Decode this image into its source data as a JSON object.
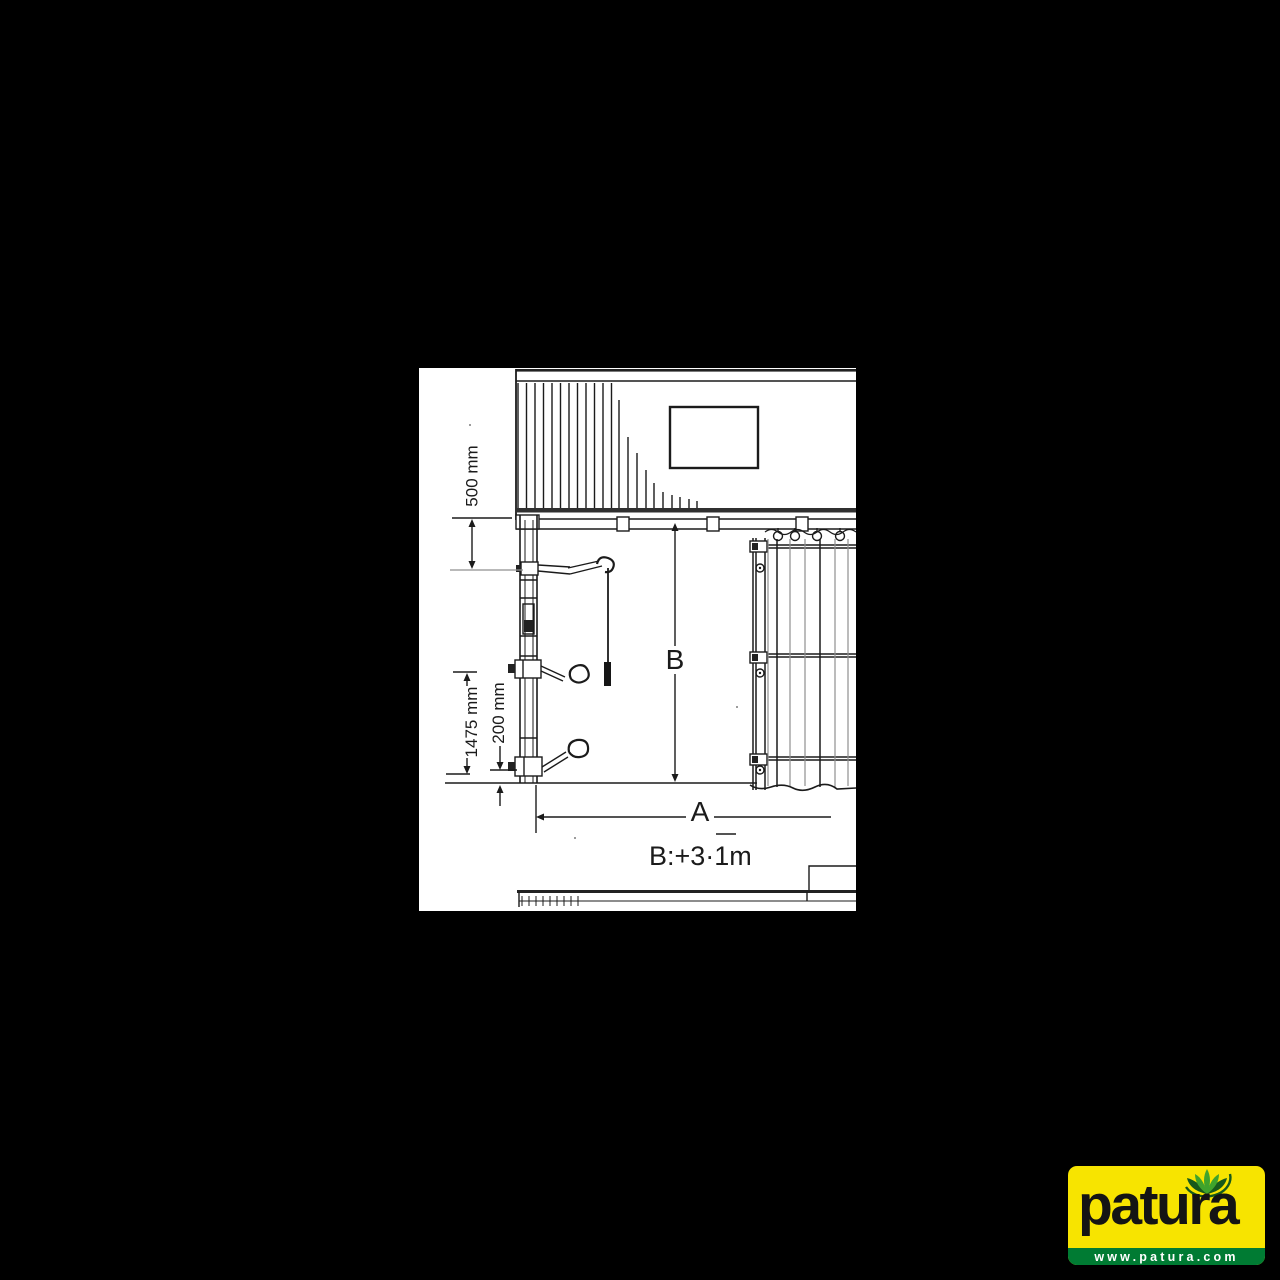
{
  "page": {
    "background": "#000000"
  },
  "diagram": {
    "paper_color": "#FFFFFF",
    "line_color": "#1B1B1B",
    "light_line_color": "#8F8F8F",
    "dimensions": {
      "top_offset": "500 mm",
      "post_height": "1475 mm",
      "bottom_offset": "200 mm",
      "height_label": "B",
      "width_label": "A",
      "formula": "B:+3·1m"
    }
  },
  "logo": {
    "brand": "patura",
    "url": "www.patura.com",
    "colors": {
      "background": "#F7E400",
      "bar": "#007B33",
      "leaf_light": "#3FA32C",
      "leaf_dark": "#17591B",
      "wordmark": "#141414",
      "url_text": "#FFFFFF"
    }
  }
}
